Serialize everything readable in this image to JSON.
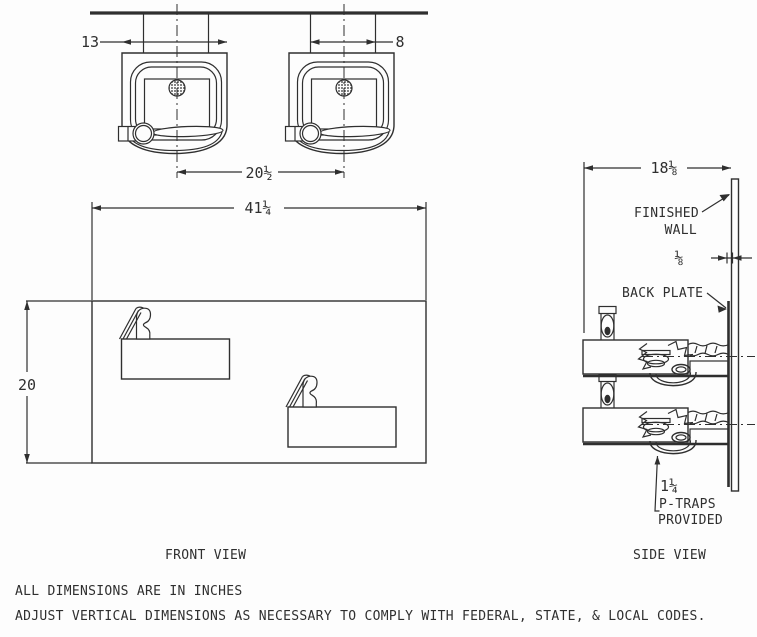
{
  "plan": {
    "dim_body_width": "13",
    "dim_rough_in": "8",
    "dim_center_spacing": "20½"
  },
  "front": {
    "dim_width": "41¼",
    "dim_height": "20",
    "caption": "FRONT VIEW"
  },
  "side": {
    "dim_depth": "18⅛",
    "dim_wall_gap": "⅛",
    "callout_finished_wall_line1": "FINISHED",
    "callout_finished_wall_line2": "WALL",
    "callout_back_plate": "BACK PLATE",
    "callout_trap_size": "1¼",
    "callout_trap_line2": "P-TRAPS",
    "callout_trap_line3": "PROVIDED",
    "caption": "SIDE VIEW"
  },
  "notes": {
    "line1": "ALL DIMENSIONS ARE IN INCHES",
    "line2": "ADJUST VERTICAL DIMENSIONS AS NECESSARY TO COMPLY WITH FEDERAL, STATE, & LOCAL CODES."
  },
  "colors": {
    "ink": "#2f2f2f",
    "paper": "#fdfdfd"
  }
}
